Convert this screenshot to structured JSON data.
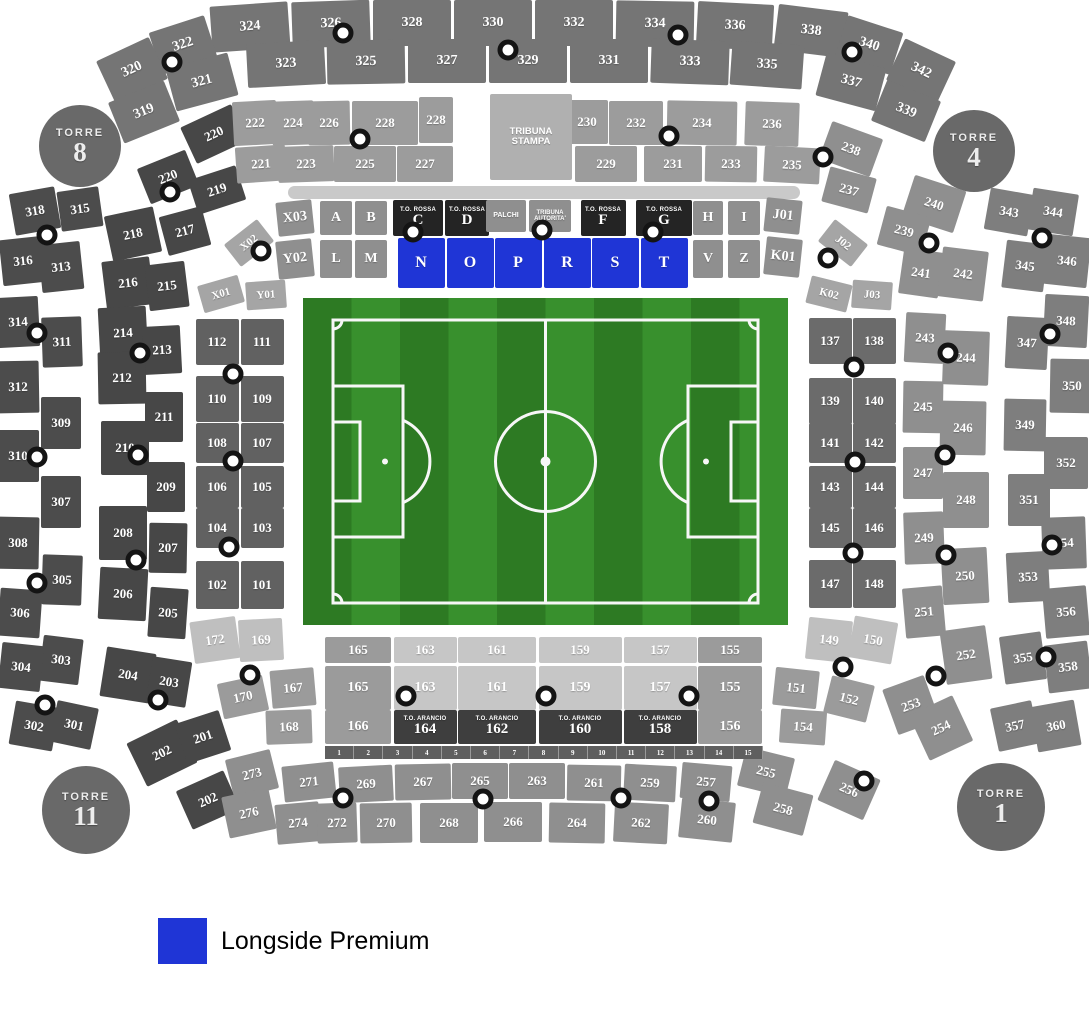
{
  "legend": {
    "label": "Longside Premium",
    "color": "#1F35D6"
  },
  "highlight": {
    "sections": [
      "N",
      "O",
      "P",
      "R",
      "S",
      "T"
    ],
    "color": "#1F35D6"
  },
  "towers": [
    {
      "name": "TORRE",
      "number": "8"
    },
    {
      "name": "TORRE",
      "number": "4"
    },
    {
      "name": "TORRE",
      "number": "11"
    },
    {
      "name": "TORRE",
      "number": "1"
    }
  ],
  "labels": {
    "tribuna_stampa": [
      "TRIBUNA",
      "STAMPA"
    ],
    "palchi": "PALCHI",
    "tribuna_autorita": [
      "TRIBUNA",
      "AUTORITA'"
    ],
    "to_rossa": "T.O. ROSSA",
    "to_arancio": "T.O. ARANCIO"
  },
  "sections": {
    "outer_top_row1": [
      "324",
      "326",
      "328",
      "330",
      "332",
      "334",
      "336",
      "338"
    ],
    "outer_top_row2": [
      "323",
      "325",
      "327",
      "329",
      "331",
      "333",
      "335"
    ],
    "outer_top_left": [
      "322",
      "320",
      "321",
      "319"
    ],
    "outer_top_right": [
      "340",
      "342",
      "337",
      "339"
    ],
    "outer_left": [
      "318",
      "315",
      "316",
      "313",
      "314",
      "311",
      "312",
      "309",
      "310",
      "307",
      "308",
      "305",
      "306",
      "303",
      "304",
      "301",
      "302"
    ],
    "outer_right": [
      "343",
      "344",
      "345",
      "346",
      "347",
      "348",
      "350",
      "349",
      "352",
      "351",
      "354",
      "353",
      "356",
      "355",
      "358",
      "357",
      "360"
    ],
    "mid_left": [
      "220",
      "220",
      "219",
      "218",
      "217",
      "216",
      "215",
      "214",
      "213",
      "212",
      "211",
      "210",
      "209",
      "208",
      "207",
      "206",
      "205",
      "204",
      "203"
    ],
    "mid_bottom_left": [
      "202",
      "201",
      "202"
    ],
    "mid_right": [
      "238",
      "237",
      "240",
      "239",
      "241",
      "242",
      "243",
      "244",
      "245",
      "246",
      "247",
      "248",
      "249",
      "250",
      "251",
      "252",
      "253",
      "254"
    ],
    "mid_top_row1": [
      "222",
      "224",
      "226",
      "228",
      "228",
      "230",
      "232",
      "234",
      "236"
    ],
    "mid_top_row2": [
      "221",
      "223",
      "225",
      "227",
      "229",
      "231",
      "233",
      "235"
    ],
    "letters_top": [
      "X03",
      "A",
      "B",
      "H",
      "I",
      "J01"
    ],
    "letters_bottom": [
      "Y02",
      "L",
      "M",
      "V",
      "Z",
      "K01"
    ],
    "letters_blue": [
      "N",
      "O",
      "P",
      "R",
      "S",
      "T"
    ],
    "to_rossa_letters": [
      "C",
      "D",
      "F",
      "G"
    ],
    "wedges_left": [
      "X02",
      "X01",
      "Y01"
    ],
    "wedges_right": [
      "J02",
      "K02",
      "J03"
    ],
    "inner_left": [
      "112",
      "111",
      "110",
      "109",
      "108",
      "107",
      "106",
      "105",
      "104",
      "103",
      "102",
      "101"
    ],
    "inner_right": [
      "137",
      "138",
      "139",
      "140",
      "141",
      "142",
      "143",
      "144",
      "145",
      "146",
      "147",
      "148"
    ],
    "inner_bottom_left": [
      "172",
      "169",
      "170",
      "167",
      "168"
    ],
    "inner_bottom_right": [
      "149",
      "150",
      "151",
      "152",
      "154"
    ],
    "bottom_row1": [
      "165",
      "163",
      "161",
      "159",
      "157",
      "155"
    ],
    "bottom_row2": [
      "165",
      "163",
      "161",
      "159",
      "157",
      "155"
    ],
    "bottom_row3_sides": [
      "166",
      "156"
    ],
    "to_arancio_numbers": [
      "164",
      "162",
      "160",
      "158"
    ],
    "bottom_band_row1": [
      "273",
      "271",
      "269",
      "267",
      "265",
      "263",
      "261",
      "259",
      "257",
      "255"
    ],
    "bottom_band_row2": [
      "276",
      "274",
      "272",
      "270",
      "268",
      "266",
      "264",
      "262",
      "260",
      "258"
    ],
    "bottom_band_right": [
      "256"
    ],
    "seat_strip": [
      "1",
      "2",
      "3",
      "4",
      "5",
      "6",
      "7",
      "8",
      "9",
      "10",
      "11",
      "12",
      "13",
      "14",
      "15"
    ]
  }
}
